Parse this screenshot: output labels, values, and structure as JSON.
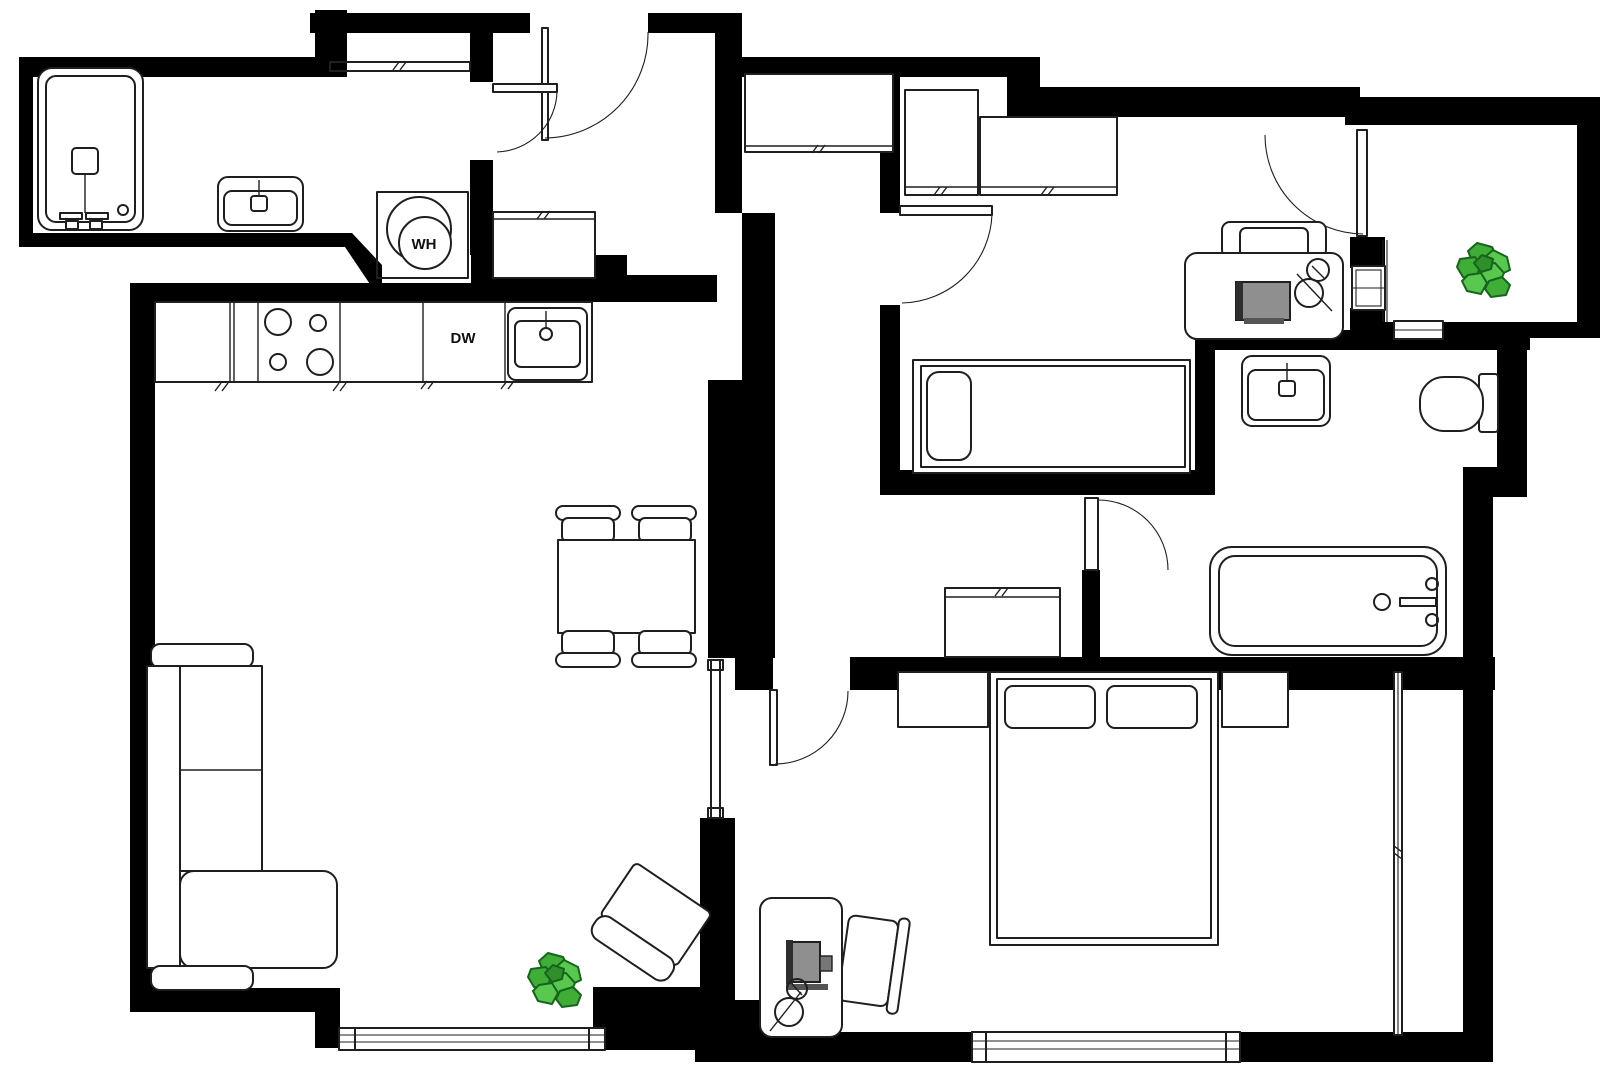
{
  "labels": {
    "water_heater": "WH",
    "dishwasher": "DW"
  },
  "colors": {
    "background": "#ffffff",
    "wall": "#000000",
    "furniture_line": "#1f1f1f",
    "monitor_dark": "#2e2e2e",
    "monitor_screen": "#8f8f8f",
    "monitor_base": "#555555",
    "monitor_knob": "#777777",
    "plant_mid": "#3fae36",
    "plant_light": "#58c84f",
    "plant_core": "#2e8f2b"
  },
  "icons": [
    "plant-icon",
    "door-arc-icon",
    "window-icon",
    "shower-icon",
    "bathtub-icon",
    "toilet-icon",
    "sink-icon",
    "stove-icon",
    "bed-icon",
    "sofa-icon",
    "armchair-icon",
    "desk-icon",
    "chair-icon",
    "water-heater-icon",
    "dining-table-icon",
    "closet-icon",
    "monitor-icon",
    "mouse-icon"
  ]
}
